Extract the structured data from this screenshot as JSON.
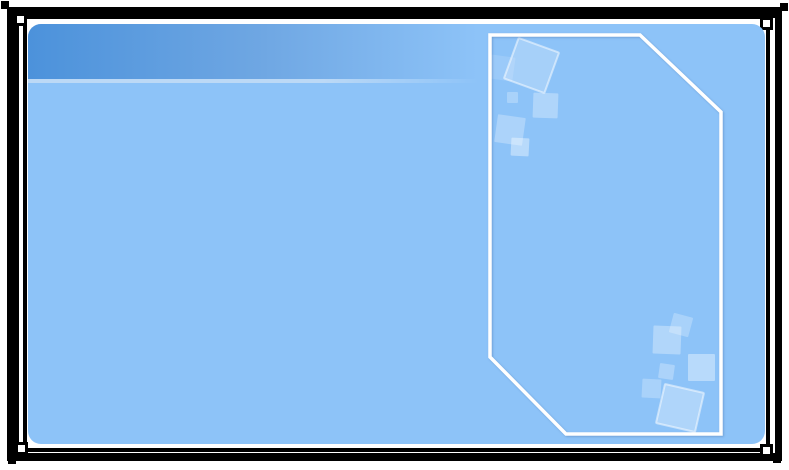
{
  "slide": {
    "background_color": "#ffffff",
    "frame_color": "#000000"
  },
  "content_area": {
    "fill": "#8dc3f8",
    "header": {
      "gradient_start": "#4c92db",
      "gradient_mid": "#6fa7e3",
      "fade_color": "rgba(141,195,248,0)",
      "fade_end_pct": 61,
      "separator_color": "#bcd9f6"
    }
  },
  "decor": {
    "panel_outline": {
      "stroke": "#ffffff",
      "stroke_width": 3.5,
      "points": "490,35 640,35 721,112 721,434 566,434 490,357"
    },
    "squares": {
      "fill": "#ffffff",
      "outline_color": "rgba(255,255,255,0.5)",
      "items": [
        {
          "x": 490,
          "y": 56,
          "size": 24,
          "rot": 8,
          "opacity": 0.13
        },
        {
          "x": 510,
          "y": 44,
          "size": 43,
          "rot": 20,
          "opacity": 0.22,
          "outlined": true
        },
        {
          "x": 507,
          "y": 92,
          "size": 11,
          "rot": 0,
          "opacity": 0.25
        },
        {
          "x": 533,
          "y": 93,
          "size": 25,
          "rot": 2,
          "opacity": 0.3
        },
        {
          "x": 496,
          "y": 116,
          "size": 28,
          "rot": 8,
          "opacity": 0.28
        },
        {
          "x": 511,
          "y": 138,
          "size": 18,
          "rot": 3,
          "opacity": 0.38
        },
        {
          "x": 671,
          "y": 315,
          "size": 20,
          "rot": 15,
          "opacity": 0.25
        },
        {
          "x": 653,
          "y": 326,
          "size": 28,
          "rot": 2,
          "opacity": 0.32
        },
        {
          "x": 688,
          "y": 354,
          "size": 27,
          "rot": 0,
          "opacity": 0.38
        },
        {
          "x": 659,
          "y": 364,
          "size": 15,
          "rot": 8,
          "opacity": 0.28
        },
        {
          "x": 642,
          "y": 379,
          "size": 19,
          "rot": 3,
          "opacity": 0.25
        },
        {
          "x": 660,
          "y": 388,
          "size": 40,
          "rot": 13,
          "opacity": 0.3,
          "outlined": true
        }
      ]
    }
  }
}
